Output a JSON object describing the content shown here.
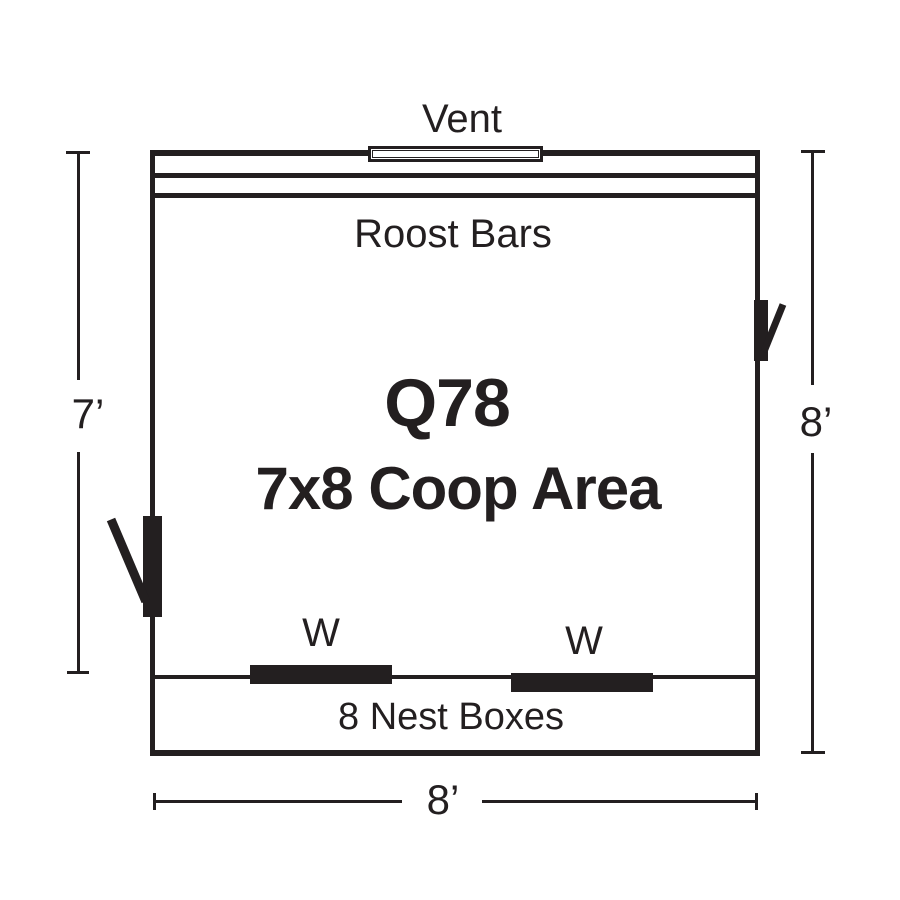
{
  "page": {
    "background": "#ffffff",
    "ink_color": "#231f20"
  },
  "floor_plan": {
    "model": "Q78",
    "area": "7x8 Coop Area",
    "vent": "Vent",
    "roost_bars": "Roost Bars",
    "nest_boxes": "8 Nest Boxes",
    "window_left": "W",
    "window_right": "W"
  },
  "dimensions": {
    "left": "7’",
    "right": "8’",
    "bottom": "8’"
  }
}
